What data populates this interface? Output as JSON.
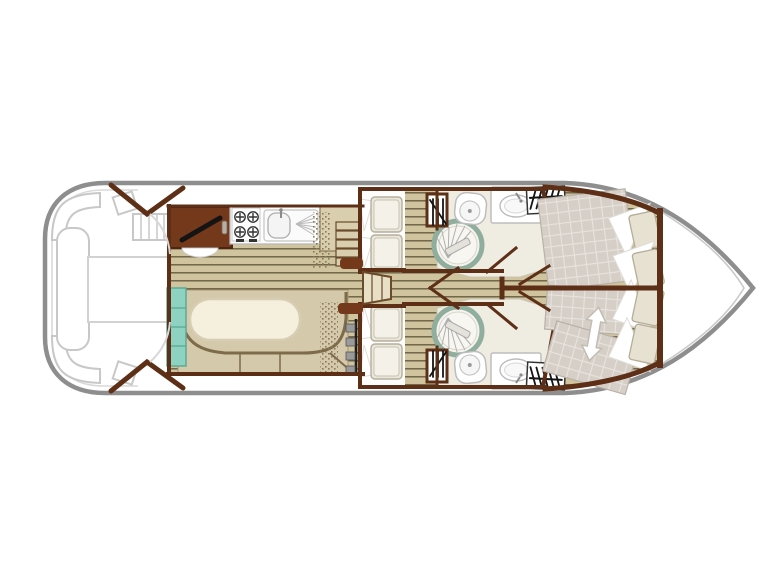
{
  "diagram": {
    "type": "boat-floor-plan",
    "view": "top-down deck layout, bow to the right, stern to the left",
    "visible_text": "none",
    "regions": [
      {
        "id": "aft-deck",
        "features": [
          "corner-bench-port",
          "corner-bench-starboard",
          "side-bench",
          "deck-table",
          "boarding-steps",
          "helm-console",
          "canopy-frame"
        ]
      },
      {
        "id": "saloon",
        "features": [
          "u-shaped-dinette",
          "oval-table",
          "entry-steps",
          "companionway-steps"
        ]
      },
      {
        "id": "galley",
        "features": [
          "worktop",
          "four-burner-stove",
          "sink-with-drainer",
          "basin",
          "counter-steps"
        ]
      },
      {
        "id": "mid-cabin-port",
        "features": [
          "bunk-bed-upper",
          "bunk-bed-lower"
        ]
      },
      {
        "id": "mid-cabin-starboard",
        "features": [
          "bunk-bed-upper",
          "bunk-bed-lower"
        ]
      },
      {
        "id": "bathroom-port",
        "features": [
          "shower-with-folding-door",
          "toilet",
          "washbasin",
          "locker",
          "wardrobe"
        ]
      },
      {
        "id": "bathroom-starboard",
        "features": [
          "shower-with-folding-door",
          "toilet",
          "washbasin",
          "locker",
          "wardrobe"
        ]
      },
      {
        "id": "bow-cabin-port",
        "features": [
          "double-bed-mattress",
          "pillows"
        ]
      },
      {
        "id": "bow-cabin-starboard",
        "features": [
          "sliding-double-bed",
          "pillows",
          "bed-slide-arrow"
        ]
      },
      {
        "id": "bow-deck",
        "features": [
          "bulkhead"
        ]
      }
    ],
    "symbols": {
      "wardrobe_symbol": "horizontal rail with hanger hatch strokes",
      "locker_symbol": "vertical hatch strokes in small box",
      "shower_symbol": "circle with sage ring and folding door fan",
      "bed_slide_symbol": "white double-headed arrow"
    }
  },
  "colors": {
    "hull_outline": "#8e8e8e",
    "inner_line": "#c9c9c9",
    "deck_outline": "#c8c8c8",
    "wall": "#5e2f17",
    "cabinet_dark": "#74381a",
    "wood_base": "#cfc49e",
    "wood_line": "#6a5e41",
    "counter": "#d9cfae",
    "counter_edge": "#8a7a58",
    "dinette": "#d5c9ab",
    "dinette_line": "#7d6b4a",
    "table": "#f5efdd",
    "table_edge": "#d6cdb2",
    "ivory": "#efece2",
    "ivory_edge": "#c9c4b4",
    "fixture_white": "#ffffff",
    "fixture_edge": "#bdbdbd",
    "shower_ring": "#8fae9e",
    "mint": "#8ed3c2",
    "mint_edge": "#57a894",
    "mattress": "#d6cfc8",
    "mattress_grid": "#e8e3dd",
    "mattress_edge": "#b9b1a8",
    "pillow": "#e7e1d2",
    "pillow_edge": "#b5ad99",
    "berth": "#e9e6da",
    "berth_edge": "#b5ae9e",
    "steps": "#e7dfc6",
    "symbol_black": "#141414",
    "rail_gray": "#9a9a9a",
    "arrow_edge": "#c2bcb2"
  }
}
